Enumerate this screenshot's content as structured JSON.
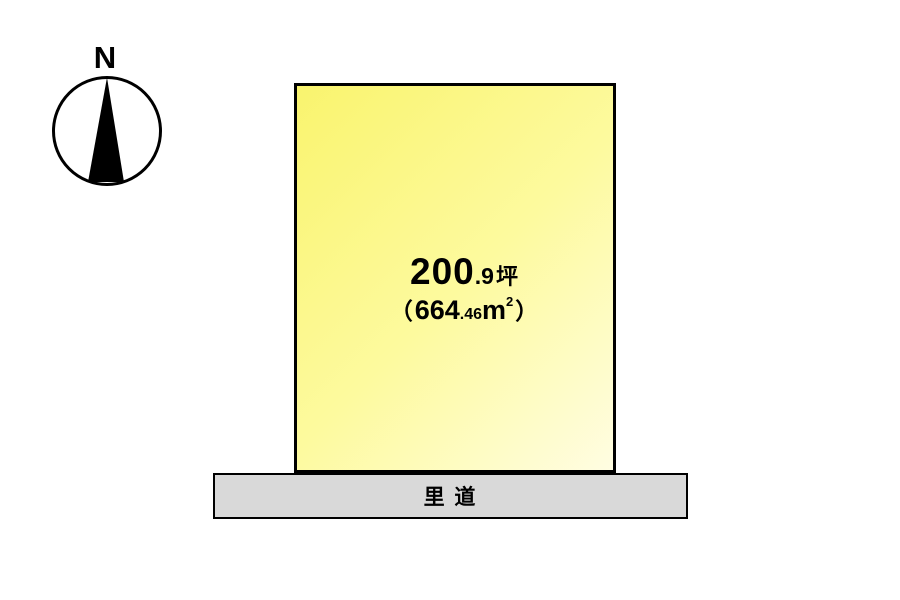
{
  "compass": {
    "north_label": "N"
  },
  "parcel": {
    "area_tsubo": {
      "whole": "200",
      "decimal": ".9",
      "unit": "坪",
      "full_text": "200.9坪"
    },
    "area_sqm": {
      "paren_open": "（",
      "whole": "664",
      "decimal": ".46",
      "unit_base": "m",
      "unit_exponent": "2",
      "paren_close": "）",
      "full_text": "（664.46㎡）"
    }
  },
  "road": {
    "label": "里 道"
  },
  "colors": {
    "background": "#ffffff",
    "parcel_gradient_start": "#f9f46e",
    "parcel_gradient_mid": "#fdfa9e",
    "parcel_gradient_end": "#fffde2",
    "parcel_border": "#000000",
    "road_fill": "#d9d9d9",
    "road_border": "#000000",
    "compass_color": "#000000",
    "text_color": "#000000"
  }
}
